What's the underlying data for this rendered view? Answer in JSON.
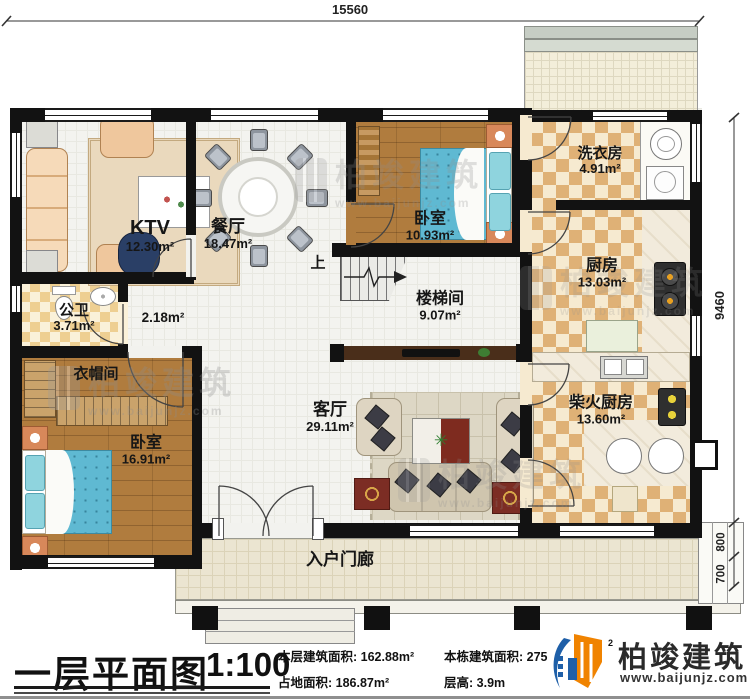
{
  "dimensions": {
    "top_width": "15560",
    "right_height": "9460",
    "right_seg_top": "800",
    "right_seg_bottom": "700"
  },
  "rooms": {
    "ktv": {
      "name": "KTV",
      "area": "12.30m²"
    },
    "dining": {
      "name": "餐厅",
      "area": "18.47m²"
    },
    "bedroom_top": {
      "name": "卧室",
      "area": "10.93m²"
    },
    "laundry": {
      "name": "洗衣房",
      "area": "4.91m²"
    },
    "kitchen": {
      "name": "厨房",
      "area": "13.03m²"
    },
    "stairwell": {
      "name": "楼梯间",
      "area": "9.07m²"
    },
    "bathroom": {
      "name": "公卫",
      "area": "3.71m²"
    },
    "hallway": {
      "area": "2.18m²"
    },
    "cloakroom": {
      "name": "衣帽间"
    },
    "bedroom_left": {
      "name": "卧室",
      "area": "16.91m²"
    },
    "living": {
      "name": "客厅",
      "area": "29.11m²"
    },
    "firewood_kitchen": {
      "name": "柴火厨房",
      "area": "13.60m²"
    },
    "porch": {
      "name": "入户门廊"
    }
  },
  "stairs": {
    "up_label": "上"
  },
  "title_bar": {
    "plan_title": "一层平面图",
    "scale": "1:100",
    "stats": {
      "floor_area_label": "本层建筑面积:",
      "floor_area_value": "162.88m²",
      "land_area_label": "占地面积:",
      "land_area_value": "186.87m²",
      "total_area_label": "本栋建筑面积:",
      "total_area_value": "275",
      "total_area_unit_sup": "2",
      "height_label": "层高:",
      "height_value": "3.9m"
    },
    "brand": {
      "name": "柏竣建筑",
      "site": "www.baijunjz.com"
    }
  },
  "watermark": {
    "brand": "柏竣建筑",
    "site": "www.baijunjz.com"
  },
  "colors": {
    "wall": "#121212",
    "wood_floor": "#b07c3e",
    "checker_tan": "#dfb176",
    "checker_cream": "#f6ead0",
    "light_floor": "#f3f3ef",
    "porch": "#ebe5d1",
    "bed_blue": "#5fb9d2",
    "brand_blue": "#1e5fa8",
    "brand_orange": "#f08300"
  }
}
